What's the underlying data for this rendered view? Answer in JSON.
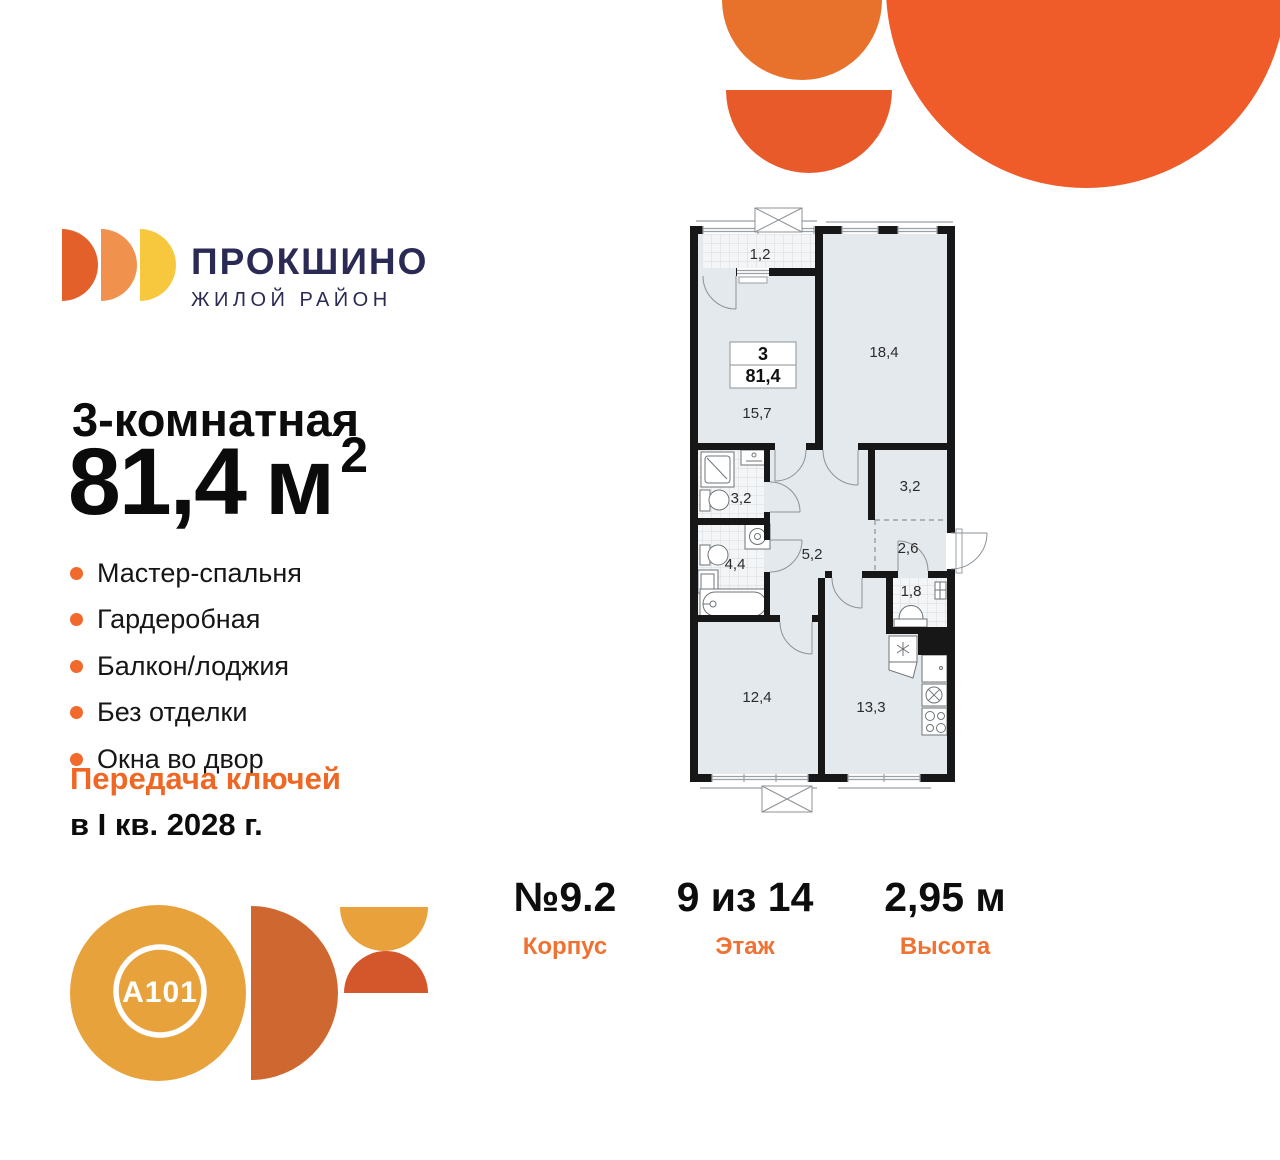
{
  "brand": {
    "name": "ПРОКШИНО",
    "tagline": "ЖИЛОЙ РАЙОН"
  },
  "listing": {
    "title": "3-комнатная",
    "area_value": "81,4",
    "area_unit": "м",
    "area_power": "2",
    "features": [
      "Мастер-спальня",
      "Гардеробная",
      "Балкон/лоджия",
      "Без отделки",
      "Окна во двор"
    ],
    "handover_title": "Передача ключей",
    "handover_term": "в I кв. 2028 г."
  },
  "floorplan": {
    "info_box": {
      "rooms": "3",
      "area": "81,4"
    },
    "room_labels": {
      "balcony": "1,2",
      "living": "15,7",
      "bedroom_top": "18,4",
      "bathroom_top": "3,2",
      "wardrobe": "3,2",
      "hall": "2,6",
      "corridor": "5,2",
      "bathroom_bottom": "4,4",
      "laundry": "1,8",
      "bedroom_bottom": "12,4",
      "kitchen": "13,3"
    }
  },
  "details": [
    {
      "value": "№9.2",
      "label": "Корпус"
    },
    {
      "value": "9 из 14",
      "label": "Этаж"
    },
    {
      "value": "2,95 м",
      "label": "Высота"
    }
  ],
  "developer": {
    "logo_text": "A101"
  },
  "colors": {
    "accent_orange": "#EF6724",
    "bullet_orange": "#F2692C",
    "label_orange": "#F07130",
    "brand_navy": "#2B2A54",
    "deco_semicircle_top": "#E8722C",
    "deco_semicircle_bottom": "#E95A2B",
    "deco_big_circle": "#EF5B29",
    "logo_amber": "#E8A23C",
    "logo_brick": "#CE6830",
    "logo_red_orange": "#D4572C",
    "plan_room_fill": "#E4E9ED"
  }
}
